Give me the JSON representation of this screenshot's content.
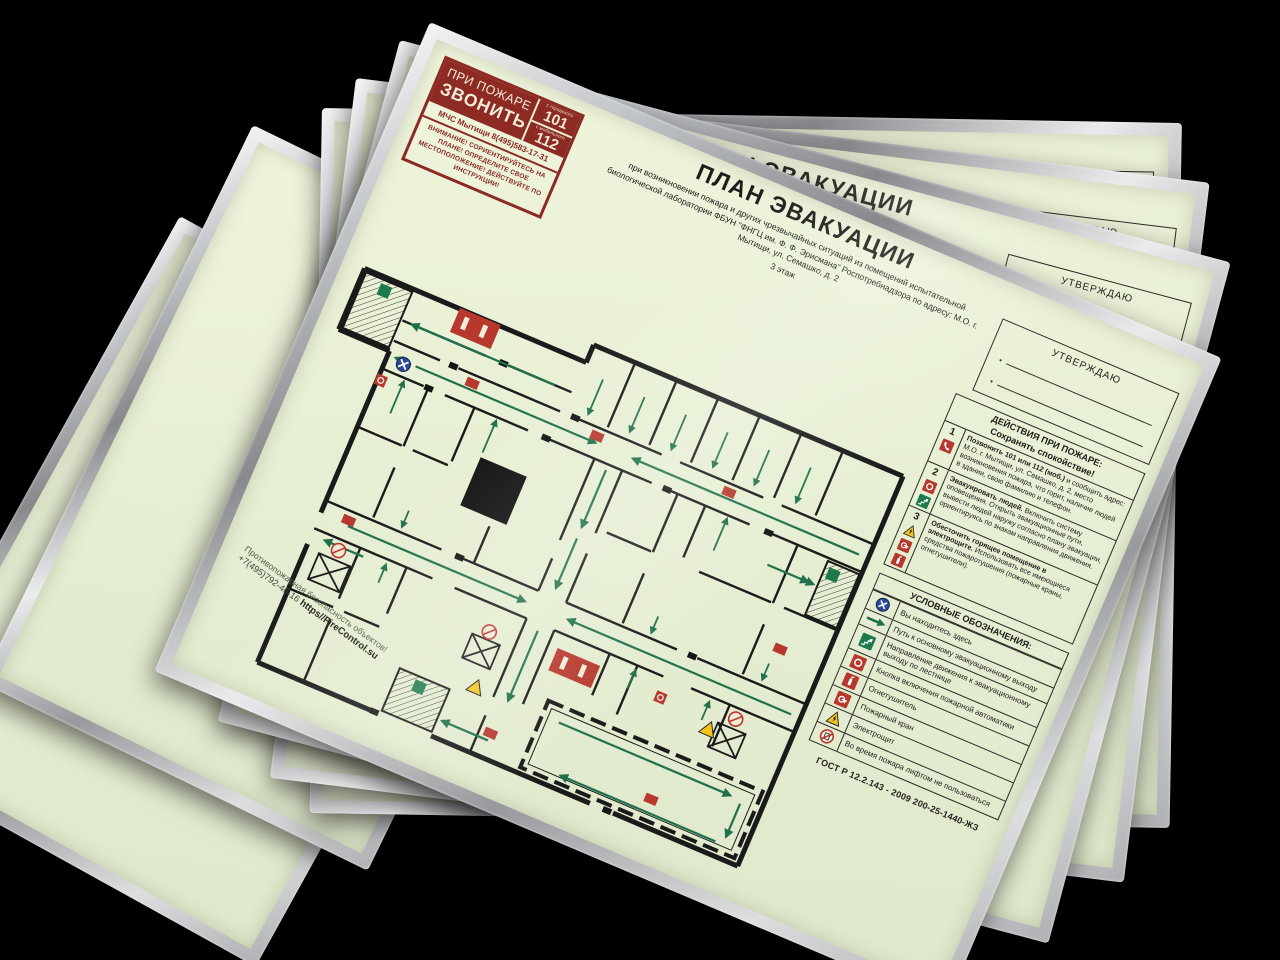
{
  "scene": {
    "background_color": "#000000",
    "frame_color": "silver",
    "paper_color": "#e7efd4",
    "accent_red": "#8c2a23",
    "icon_red": "#b7392e",
    "route_green": "#20714b",
    "wall_black": "#1a1a1a",
    "frames_in_stack": "5"
  },
  "call_box": {
    "line1": "ПРИ ПОЖАРЕ",
    "line2": "ЗВОНИТЬ",
    "num1_label": "с городского",
    "num1": "101",
    "num2_label": "с мобильного",
    "num2": "112",
    "agency": "МЧС Мытищи 8(495)583-17-31",
    "warning": "ВНИМАНИЕ! СОРИЕНТИРУЙТЕСЬ НА ПЛАНЕ! ОПРЕДЕЛИТЕ СВОЕ МЕСТОПОЛОЖЕНИЕ! ДЕЙСТВУЙТЕ ПО ИНСТРУКЦИИ!"
  },
  "title_block": {
    "title": "ПЛАН ЭВАКУАЦИИ",
    "subtitle": "при возникновении пожара и других чрезвычайных ситуаций из помещений испытательной биологической лаборатории ФБУН \"ФНГЦ им. Ф. Ф. Эрисмана\" Роспотребнадзора по адресу: М.О. г. Мытищи, ул. Семашко, д. 2",
    "floor": "3 этаж"
  },
  "approve": {
    "label": "УТВЕРЖДАЮ"
  },
  "actions": {
    "heading": "ДЕЙСТВИЯ ПРИ ПОЖАРЕ:",
    "subheading": "Сохранять спокойствие!",
    "items": [
      {
        "num": "1",
        "icons": [
          "phone"
        ],
        "lead": "Позвонить 101 или 112 (моб.)",
        "rest": "и сообщить адрес: М.О. г. Мытищи, ул. Семашко, д. 2, место возникновения пожара, что горит, наличие людей в здании, свою фамилию и телефон."
      },
      {
        "num": "2",
        "icons": [
          "fire-button",
          "exit-stairs"
        ],
        "lead": "Эвакуировать людей.",
        "rest": "Включить систему оповещения. Открыть эвакуационные пути, вывести людей наружу согласно плану эвакуации, ориентируясь по знакам направления движения."
      },
      {
        "num": "3",
        "icons": [
          "electro",
          "fire-hose",
          "extinguisher"
        ],
        "lead": "Обесточить горящее помещение в электрощите.",
        "rest": "Использовать все имеющиеся средства пожаротушения (пожарные краны, огнетушители)."
      }
    ]
  },
  "legend": {
    "heading": "УСЛОВНЫЕ ОБОЗНАЧЕНИЯ:",
    "items": [
      {
        "icon": "you-are-here",
        "label": "Вы находитесь здесь"
      },
      {
        "icon": "route-arrow",
        "label": "Путь к основному эвакуационному выходу"
      },
      {
        "icon": "exit-stairs",
        "label": "Направление движения к эвакуационному выходу по лестнице"
      },
      {
        "icon": "fire-button",
        "label": "Кнопка включения пожарной автоматики"
      },
      {
        "icon": "extinguisher",
        "label": "Огнетушитель"
      },
      {
        "icon": "fire-hose",
        "label": "Пожарный кран"
      },
      {
        "icon": "electro",
        "label": "Электрощит"
      },
      {
        "icon": "no-lift",
        "label": "Во время пожара лифтом не пользоваться"
      }
    ]
  },
  "footer": {
    "gost": "ГОСТ Р 12.2.143 - 2009 200-25-1440-ЖЗ"
  },
  "watermark": {
    "line1": "Противопожарная безопасность объектов!",
    "line2": "+7(495)792-46-16",
    "site": "https//FireControl.su"
  }
}
